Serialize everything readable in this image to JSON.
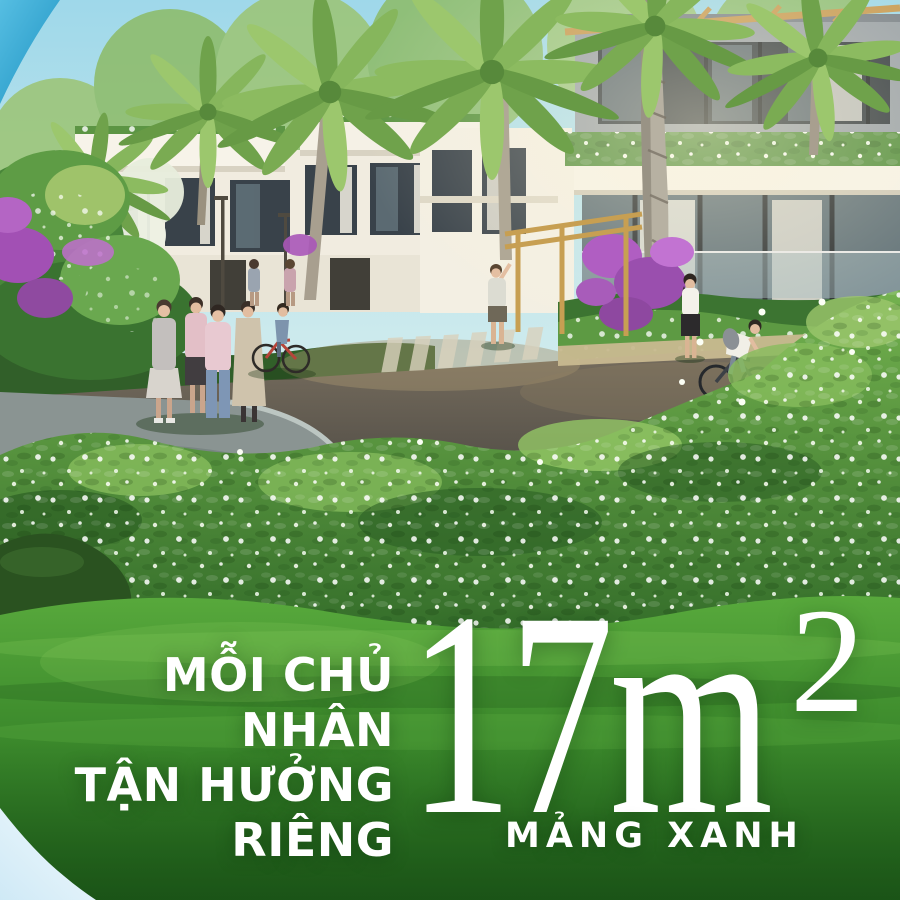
{
  "poster": {
    "language": "vi",
    "description": "Sunlit 3D render of a modern seaside villa neighborhood: white villas with rooftop gardens, palm trees, purple bougainvillea, flowering white bushes, a curved asphalt road with pedestrians and cyclists, and a bright green lawn in the foreground with a large headline.",
    "headline": {
      "line1": "MỖI CHỦ NHÂN",
      "line2": "TẬN HƯỞNG",
      "line3": "RIÊNG"
    },
    "area": {
      "value": "17",
      "unit": "m",
      "exponent": "2",
      "caption": "MẢNG XANH"
    },
    "colors": {
      "headline_text": "#ffffff",
      "corner_accent_blue": "#2fa3d2",
      "corner_accent_light": "#e6f4fb",
      "sky": "#a9ddec",
      "lawn_green": "#3c8a2c",
      "foliage_green": "#4f8f3d",
      "bougainvillea_purple": "#a855b8",
      "road_asphalt": "#55504a",
      "villa_white": "#f4f0e6",
      "wood_accent": "#c79b55"
    }
  }
}
